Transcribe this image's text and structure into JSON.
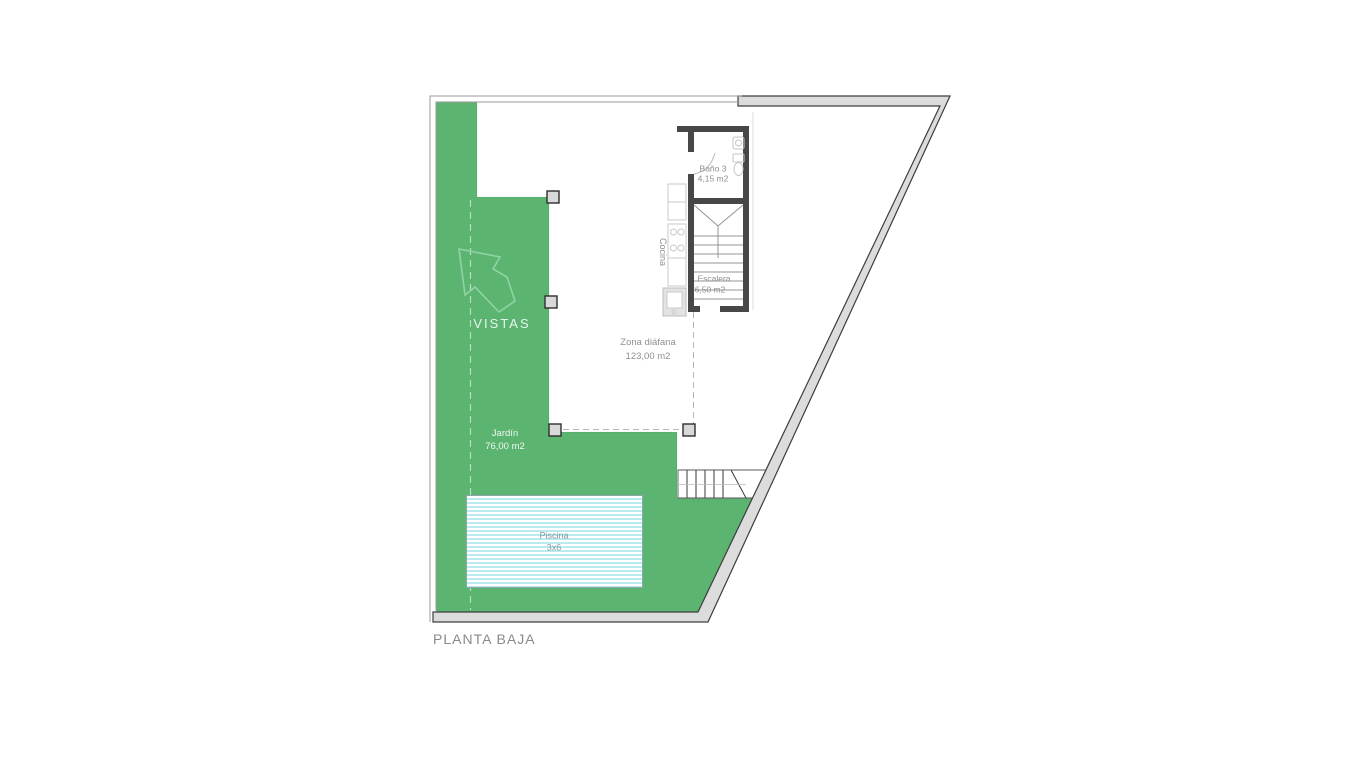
{
  "plan": {
    "title": "PLANTA BAJA",
    "type": "floor-plan"
  },
  "rooms": {
    "bano": {
      "name": "Baño 3",
      "area": "4,15 m2"
    },
    "escalera": {
      "name": "Escalera",
      "area": "6,50 m2"
    },
    "cocina": {
      "name": "Cocina"
    },
    "zona_diafana": {
      "name": "Zona diáfana",
      "area": "123,00 m2"
    },
    "jardin": {
      "name": "Jardín",
      "area": "76,00 m2"
    },
    "piscina": {
      "name": "Piscina",
      "size": "3x6"
    }
  },
  "annotations": {
    "vistas": "VISTAS"
  },
  "icons": {
    "vistas_arrow": "arrow-up-left"
  },
  "colors": {
    "garden_green": "#5cb471",
    "arrow_outline": "#8fd4a4",
    "wall_fill": "#dcdcdc",
    "wall_outline": "#3d3d3d",
    "interior_wall": "#474747",
    "pool_stripe": "#b9eaed",
    "pool_border": "#8fa6ad",
    "label_gray": "#8a8a8a",
    "label_white": "#eef8f1",
    "fixture_gray": "#c8c8c8"
  }
}
